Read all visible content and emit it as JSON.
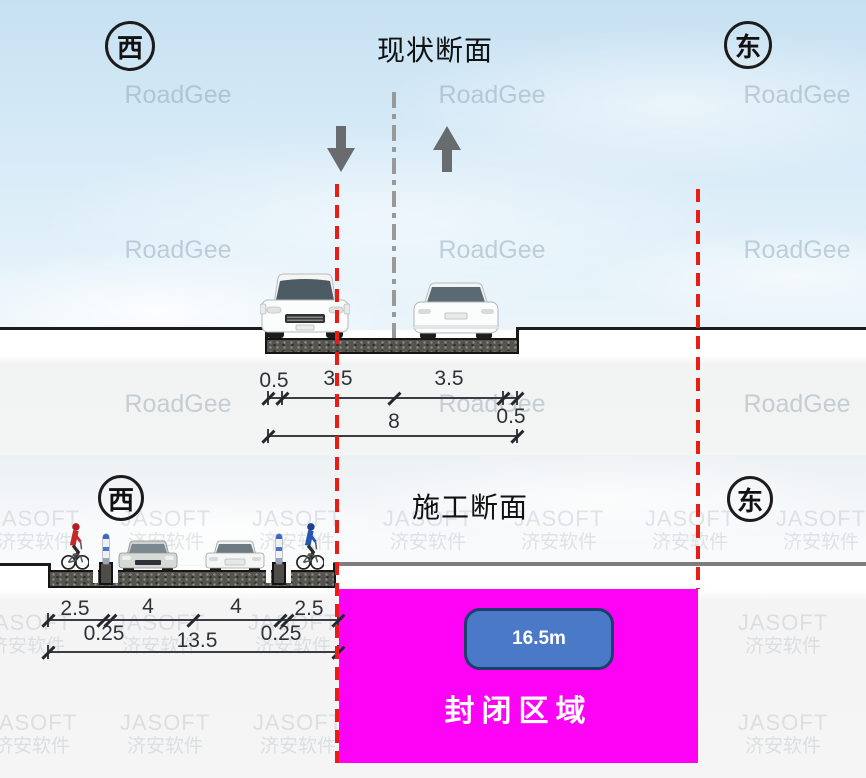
{
  "diagram": {
    "top": {
      "title": "现状断面",
      "west": "西",
      "east": "东",
      "dims": {
        "d1": "0.5",
        "d2": "3.5",
        "d3": "3.5",
        "d4": "0.5",
        "total": "8"
      }
    },
    "bottom": {
      "title": "施工断面",
      "west": "西",
      "east": "东",
      "dims": {
        "d1": "2.5",
        "d2": "4",
        "d3": "4",
        "d4": "2.5",
        "s1": "0.25",
        "s2": "0.25",
        "total": "13.5"
      },
      "closed_area": {
        "width": "16.5m",
        "label": "封闭区域"
      }
    },
    "watermarks": {
      "roadgee": "RoadGee",
      "jasoft1": "JASOFT",
      "jasoft2": "济安软件"
    },
    "colors": {
      "closed_area_fill": "#fd02f4",
      "width_badge_fill": "#4a79c8",
      "boundary_red": "#ea1d15",
      "centerline_gray": "#97999b"
    }
  }
}
